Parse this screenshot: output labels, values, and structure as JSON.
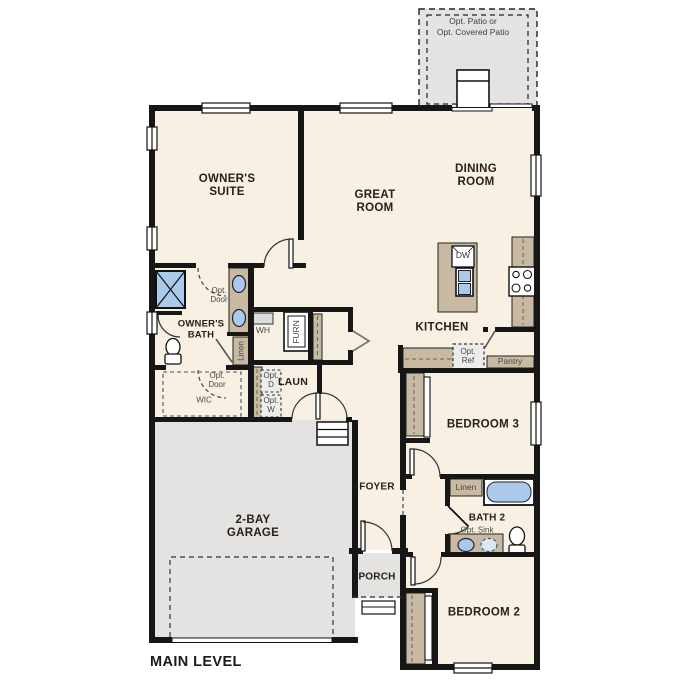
{
  "plan_title": "MAIN LEVEL",
  "labels": {
    "patio_line1": "Opt. Patio or",
    "patio_line2": "Opt. Covered Patio",
    "owners_suite": "OWNER'S SUITE",
    "great_room": "GREAT ROOM",
    "dining_room": "DINING ROOM",
    "kitchen": "KITCHEN",
    "owners_bath": "OWNER'S BATH",
    "wic": "WIC",
    "opt_door": "Opt. Door",
    "linen": "Linen",
    "wh": "WH",
    "furn": "FURN",
    "laun": "LAUN",
    "opt_d": "Opt. D",
    "opt_w": "Opt. W",
    "dw": "DW",
    "opt_ref": "Opt. Ref",
    "pantry": "Pantry",
    "bedroom3": "BEDROOM 3",
    "bath2": "BATH 2",
    "opt_sink": "Opt. Sink",
    "bedroom2": "BEDROOM 2",
    "foyer": "FOYER",
    "porch": "PORCH",
    "garage": "2-BAY GARAGE"
  },
  "fixtures": [
    "shower",
    "double-vanity-sinks",
    "toilet",
    "linen-closet",
    "water-heater",
    "furnace",
    "optional-washer",
    "optional-dryer",
    "kitchen-island",
    "dishwasher",
    "island-sink",
    "cooktop",
    "optional-refrigerator",
    "pantry-shelf",
    "bathtub",
    "optional-sink",
    "coat-closet",
    "garage-steps",
    "patio-step",
    "porch-step",
    "garage-door",
    "sliding-glass-door"
  ],
  "colors": {
    "floor": "#f7f0e3",
    "exterior_concrete": "#e4e3e1",
    "cabinetry_tan": "#c8b9a2",
    "plumbing_blue": "#abc9e9",
    "wall_black": "#161616",
    "optional_gray": "#ececec",
    "text_dark": "#262219",
    "text_muted": "#4e483d"
  }
}
